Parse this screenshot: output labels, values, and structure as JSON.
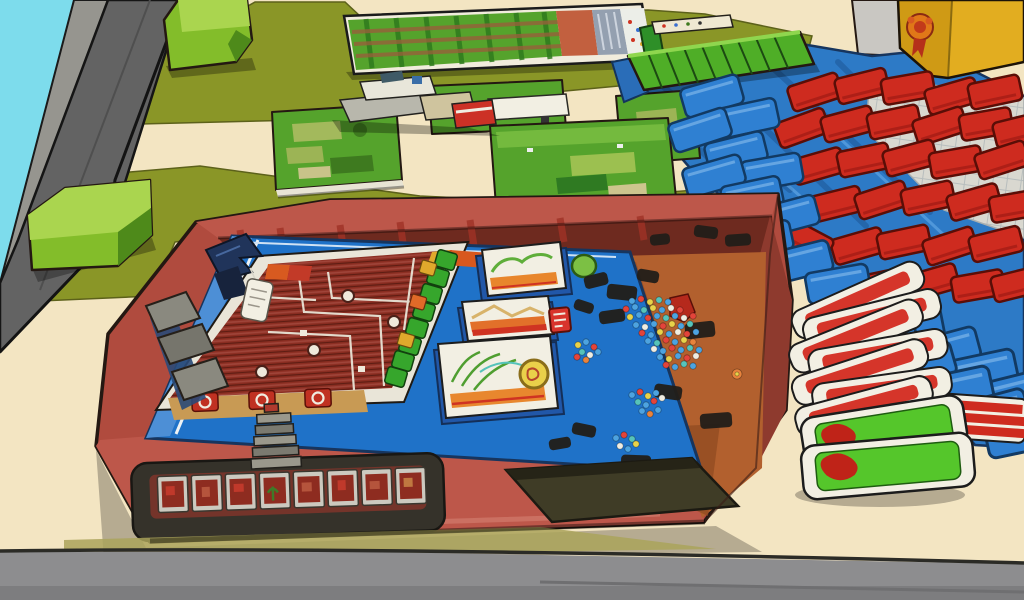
{
  "scene": {
    "description": "Cartoon illustration of a tabletop board game spread on a cream table: a red game box holding a blue-framed dark red play board with a green track, three score cards, a pile of colored beads, a flag marker, a strip of eight framed tiles in a dark recess; around it an olive felt mat with green tiles, a long farm board, lime green boxes, a blue mat with stacked blue and red pieces, a yellow box with an award emblem, a splayed stack of red and green cards, a gray steel beam and cyan sky in the top-left corner, gray floor in front.",
    "labels": {
      "sky": "cyan sky corner",
      "steelBeam": "gray steel beam",
      "wallPanel": "gray wall panel",
      "feltMat": "olive felt mat",
      "greenBoxTop": "lime green box (top)",
      "greenBoxLower": "lime green box (left)",
      "farmBoard": "long farm game board",
      "pieceCluster": "small gray and red piece cluster",
      "greenTiles": "green grass tiles",
      "rulerStrip": "small white strip piece",
      "blueMat": "blue play mat",
      "greenRamp": "green ridged ramp box",
      "gridMat": "light gray grid mat",
      "redPieceStack": "wall of stacked red pieces",
      "bluePieceStack": "cascade of stacked blue pieces",
      "yellowBox": "yellow box with award emblem",
      "awardEmblem": "orange award emblem",
      "gameBox": "red board game box",
      "boardFrame": "blue board frame",
      "playField": "dark red hatched play field",
      "greenTrack": "green square track",
      "scoreCards": "three white score cards",
      "beadPile": "pile of colored beads",
      "flagMarker": "dark blue flag marker with white tag",
      "leftRimSegments": "gray rim segments",
      "stepsPiece": "gray steps piece",
      "tileStrip": "recessed strip of framed tiles",
      "storageRecess": "dark storage recess",
      "cardStack": "splayed stack of red and green cards",
      "tableEdge": "table edge",
      "floor": "gray floor"
    }
  },
  "counts": {
    "score_cards": 3,
    "tile_strip_tiles": 8,
    "stacked_cards_right": 9,
    "bead_color_variants": 8,
    "track_squares": 8
  },
  "palette": {
    "sky": "#7ddcec",
    "beamLight": "#96958f",
    "beamDark": "#636363",
    "wallPanel": "#c9c7c2",
    "table": "#f3e5c2",
    "floor": "#8d8d8f",
    "floorDark": "#7d7d7f",
    "mat": "#8a9627",
    "lime": "#83bd2a",
    "limeTop": "#aad54f",
    "limeDark": "#4e8a1a",
    "tileGreen": "#55a32c",
    "rampGreen": "#4fae27",
    "blueMat": "#2d7ac6",
    "bluePiece": "#2f80d2",
    "redPiece": "#ce2b1f",
    "yellowBoxLeft": "#cf9a15",
    "yellowBoxRight": "#e2ad20",
    "boxRed": "#b04b3e",
    "boxRedDark": "#8e3a2e",
    "boxApron": "#bd574a",
    "boardFrame": "#1f72c8",
    "boardFrameLight": "#4d8fd6",
    "fieldRed": "#8c2e22",
    "trayOrange": "#b2602e",
    "trayShadow": "#8f4a21",
    "cardWhite": "#f2efe3",
    "cardRedFace": "#d5352a",
    "cardGreenFace": "#55c62b",
    "trackGreen": "#36a62c",
    "maroonBand": "#6e2a1f",
    "tanStrip": "#c89a54",
    "gridMat": "#d9d8d0",
    "bead0": "#4da3e0",
    "bead1": "#e3443a",
    "bead2": "#e8d24a",
    "bead3": "#f0ede2",
    "bead4": "#56c3ba",
    "bead5": "#e8833c",
    "bead6": "#3a6fd0",
    "bead7": "#d8689a"
  }
}
